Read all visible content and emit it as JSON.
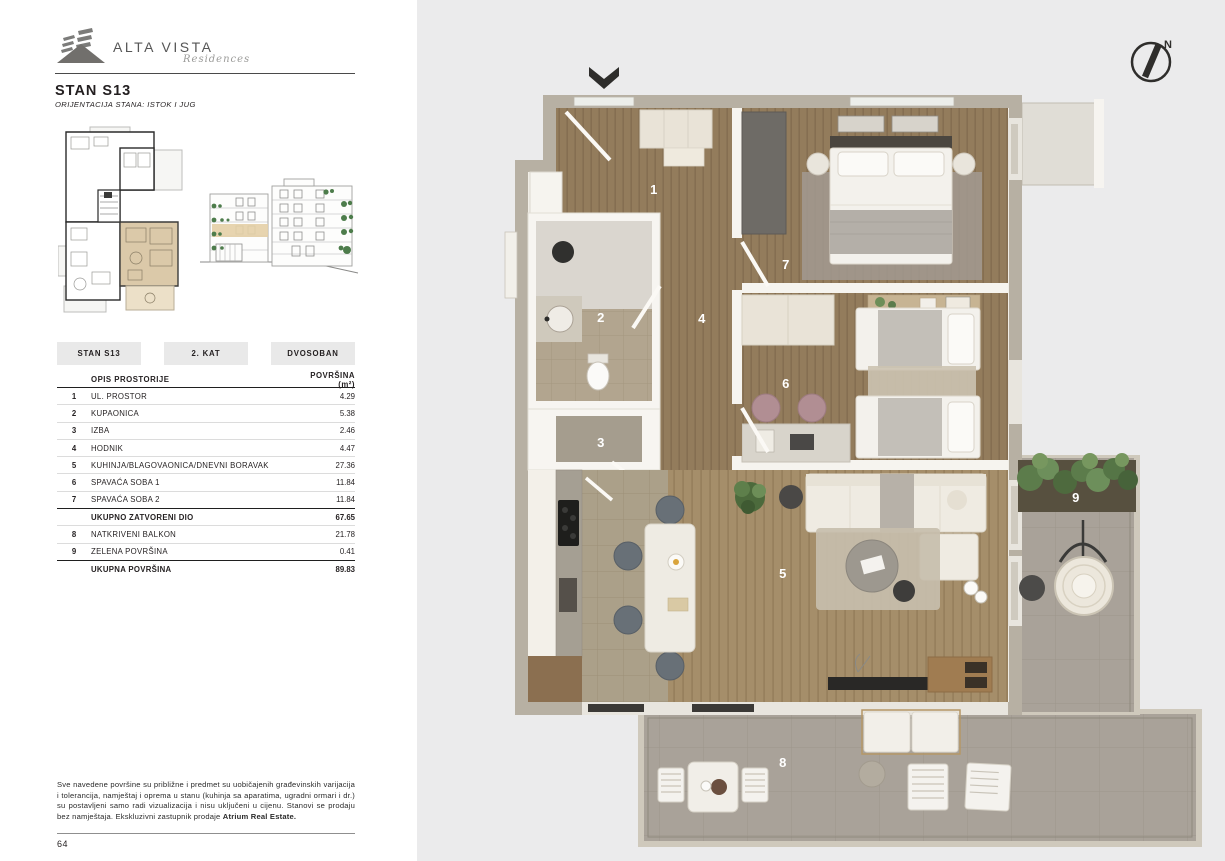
{
  "brand": {
    "name": "ALTA VISTA",
    "tagline": "Residences"
  },
  "header": {
    "title": "STAN S13",
    "orientation": "ORIJENTACIJA STANA: ISTOK I JUG",
    "doc_type": "TLOCRT I POVRŠINE"
  },
  "badges": {
    "unit": "STAN S13",
    "floor": "2. KAT",
    "type": "DVOSOBAN"
  },
  "area_table": {
    "header": {
      "room": "OPIS PROSTORIJE",
      "area": "POVRŠINA (m²)"
    },
    "rows": [
      {
        "num": "1",
        "label": "UL. PROSTOR",
        "area": "4.29"
      },
      {
        "num": "2",
        "label": "KUPAONICA",
        "area": "5.38"
      },
      {
        "num": "3",
        "label": "IZBA",
        "area": "2.46"
      },
      {
        "num": "4",
        "label": "HODNIK",
        "area": "4.47"
      },
      {
        "num": "5",
        "label": "KUHINJA/BLAGOVAONICA/DNEVNI BORAVAK",
        "area": "27.36"
      },
      {
        "num": "6",
        "label": "SPAVAĆA SOBA 1",
        "area": "11.84"
      },
      {
        "num": "7",
        "label": "SPAVAĆA SOBA 2",
        "area": "11.84"
      }
    ],
    "subtotal": {
      "label": "UKUPNO ZATVORENI DIO",
      "area": "67.65"
    },
    "outdoor_rows": [
      {
        "num": "8",
        "label": "NATKRIVENI BALKON",
        "area": "21.78"
      },
      {
        "num": "9",
        "label": "ZELENA POVRŠINA",
        "area": "0.41"
      }
    ],
    "total": {
      "label": "UKUPNA POVRŠINA",
      "area": "89.83"
    }
  },
  "disclaimer": {
    "text": "Sve navedene površine su približne i predmet su uobičajenih građevinskih varijacija i tolerancija, namještaj i oprema u stanu (kuhinja sa aparatima, ugradni ormari i dr.) su postavljeni samo radi vizualizacija i nisu uključeni u cijenu. Stanovi se prodaju bez namještaja. Ekskluzivni zastupnik prodaje ",
    "agent": "Atrium Real Estate."
  },
  "page_number": "64",
  "floor_plan": {
    "compass": "N",
    "room_labels": {
      "r1": "1",
      "r2": "2",
      "r3": "3",
      "r4": "4",
      "r5": "5",
      "r6": "6",
      "r7": "7",
      "r8": "8",
      "r9": "9"
    }
  },
  "colors": {
    "highlight_beige": "#dbc9a9",
    "wall_taupe": "#b7b0a3",
    "wood_floor": "#957d5d",
    "balcony_gray": "#a9a299",
    "greenery": "#5c7c4b",
    "right_panel_bg": "#ebebec"
  }
}
